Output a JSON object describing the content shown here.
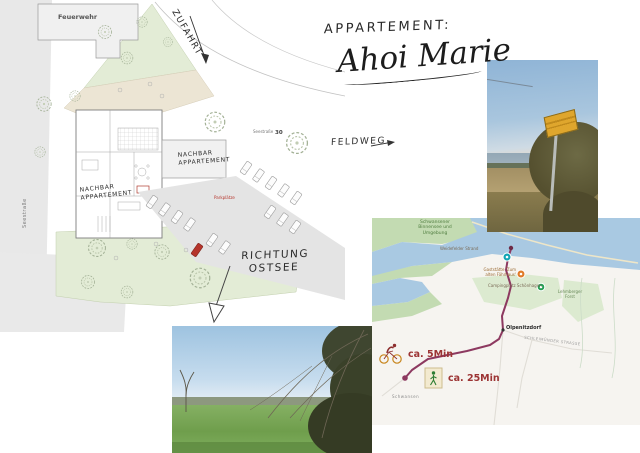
{
  "title": {
    "label": "APPARTEMENT:",
    "name": "Ahoi Marie"
  },
  "site_plan": {
    "feuerwehr": "Feuerwehr",
    "street_name": "Seestraße",
    "address_street": "Seestraße",
    "address_number": "30",
    "zufahrt": "ZUFAHRT",
    "feldweg": "FELDWEG",
    "neighbor": {
      "l1": "NACHBAR",
      "l2": "APPARTEMENT"
    },
    "parking": "Parkplätze",
    "richtung": {
      "l1": "RICHTUNG",
      "l2": "OSTSEE"
    },
    "colors": {
      "garden_green": "#e3ecd6",
      "meadow_tan": "#ece5d4",
      "accent_red": "#b5342b"
    }
  },
  "map": {
    "nature_area": {
      "l1": "Schwansener",
      "l2": "Binnensee und",
      "l3": "Umgebung"
    },
    "beach_label": "Weidefelder Strand",
    "restaurant": {
      "l1": "Gaststätte 'Zum",
      "l2": "alten Fährhaus'"
    },
    "camping": "Campingplatz Schönhagen",
    "forest": {
      "l1": "Lehmberger",
      "l2": "Forst"
    },
    "town": "Olpenitzdorf",
    "street": "SCHLEIMÜNDER STRASSE",
    "area": "Schwansen",
    "bike_time": "ca. 5Min",
    "walk_time": "ca. 25Min",
    "colors": {
      "route": "#8d3960",
      "water": "#a9c9e2",
      "nature_green": "#c3dbb2",
      "patch_green": "#dcead0",
      "time_text": "#9c3434"
    }
  }
}
